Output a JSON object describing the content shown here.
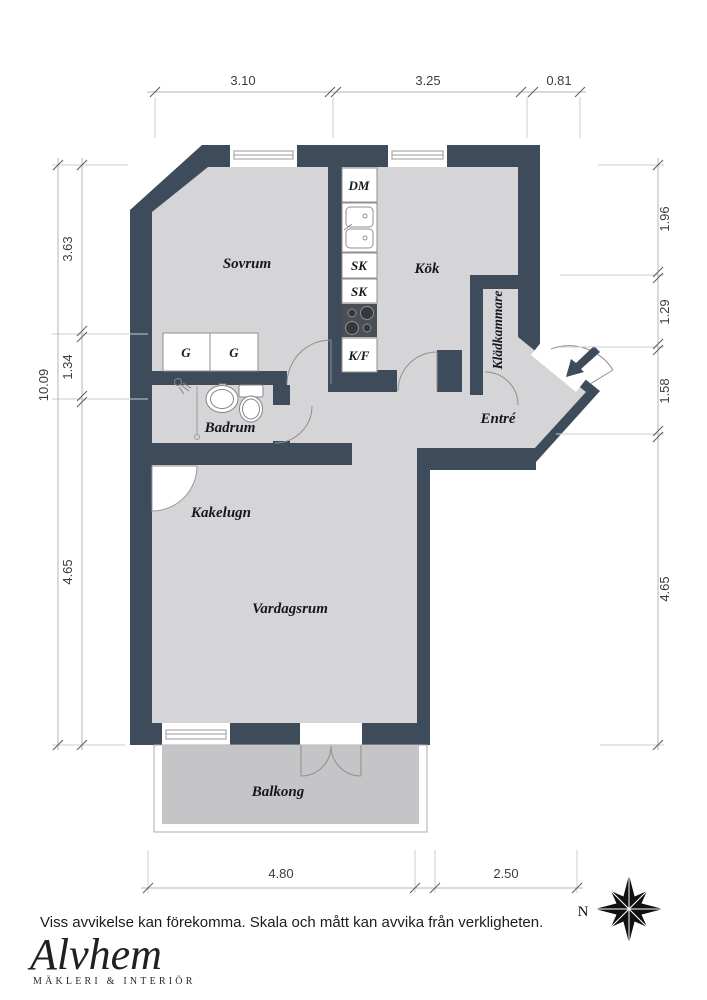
{
  "colors": {
    "wall": "#3e4b5a",
    "floor": "#d5d5d7",
    "balcony_floor": "#c5c5c7",
    "fixture_stroke": "#8f8f8f",
    "dim_line": "#c9c9c9",
    "dim_text": "#3d3d3d"
  },
  "rooms": {
    "sovrum": "Sovrum",
    "kok": "Kök",
    "badrum": "Badrum",
    "entre": "Entré",
    "vardagsrum": "Vardagsrum",
    "balkong": "Balkong",
    "kakelugn": "Kakelugn",
    "kladkammare": "Klädkammare"
  },
  "fixtures": {
    "dm": "DM",
    "sk1": "SK",
    "sk2": "SK",
    "kf": "K/F",
    "g1": "G",
    "g2": "G"
  },
  "dimensions": {
    "top": {
      "d1": "3.10",
      "d2": "3.25",
      "d3": "0.81"
    },
    "left": {
      "total": "10.09",
      "d1": "3.63",
      "d2": "1.34",
      "d3": "4.65"
    },
    "right": {
      "d1": "1.96",
      "d2": "1.29",
      "d3": "1.58",
      "d4": "4.65"
    },
    "bottom": {
      "d1": "4.80",
      "d2": "2.50"
    }
  },
  "compass": {
    "north": "N"
  },
  "footer": {
    "disclaimer": "Viss avvikelse kan förekomma. Skala och mått kan avvika från verkligheten.",
    "brand": "Alvhem",
    "tagline": "MÄKLERI & INTERIÖR"
  }
}
